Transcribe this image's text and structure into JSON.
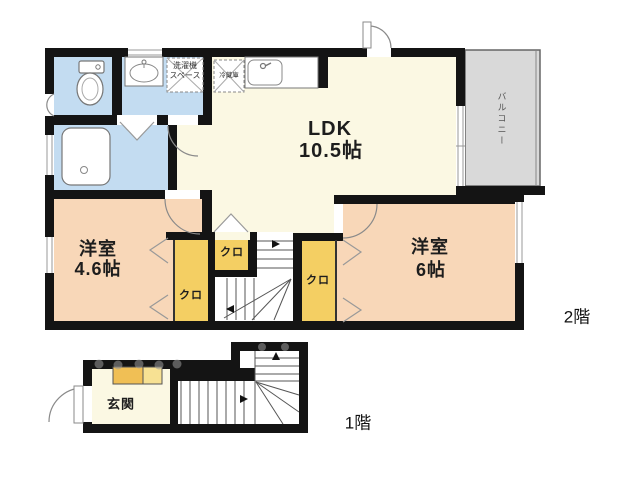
{
  "floor2": {
    "label": "2階",
    "ldk": {
      "name": "LDK",
      "size": "10.5帖"
    },
    "bedroom_left": {
      "name": "洋室",
      "size": "4.6帖"
    },
    "bedroom_right": {
      "name": "洋室",
      "size": "6帖"
    },
    "closet_tall": {
      "name": "クロ"
    },
    "closet_small": {
      "name": "クロ"
    },
    "closet_right": {
      "name": "クロ"
    },
    "balcony": {
      "name": "バルコニー"
    },
    "fridge": {
      "name": "冷蔵庫"
    },
    "washer": {
      "line1": "洗濯機",
      "line2": "スペース"
    }
  },
  "floor1": {
    "label": "1階",
    "entrance": {
      "name": "玄関"
    }
  },
  "colors": {
    "wall": "#141414",
    "ldk_cream": "#fbf8e3",
    "bedroom_peach": "#f8d7b8",
    "closet_yellow": "#f4cf63",
    "wet_blue": "#c3dcf1",
    "balcony_gray": "#d9d9d9",
    "shoe_left": "#f0bf55",
    "shoe_right": "#f7e193"
  }
}
